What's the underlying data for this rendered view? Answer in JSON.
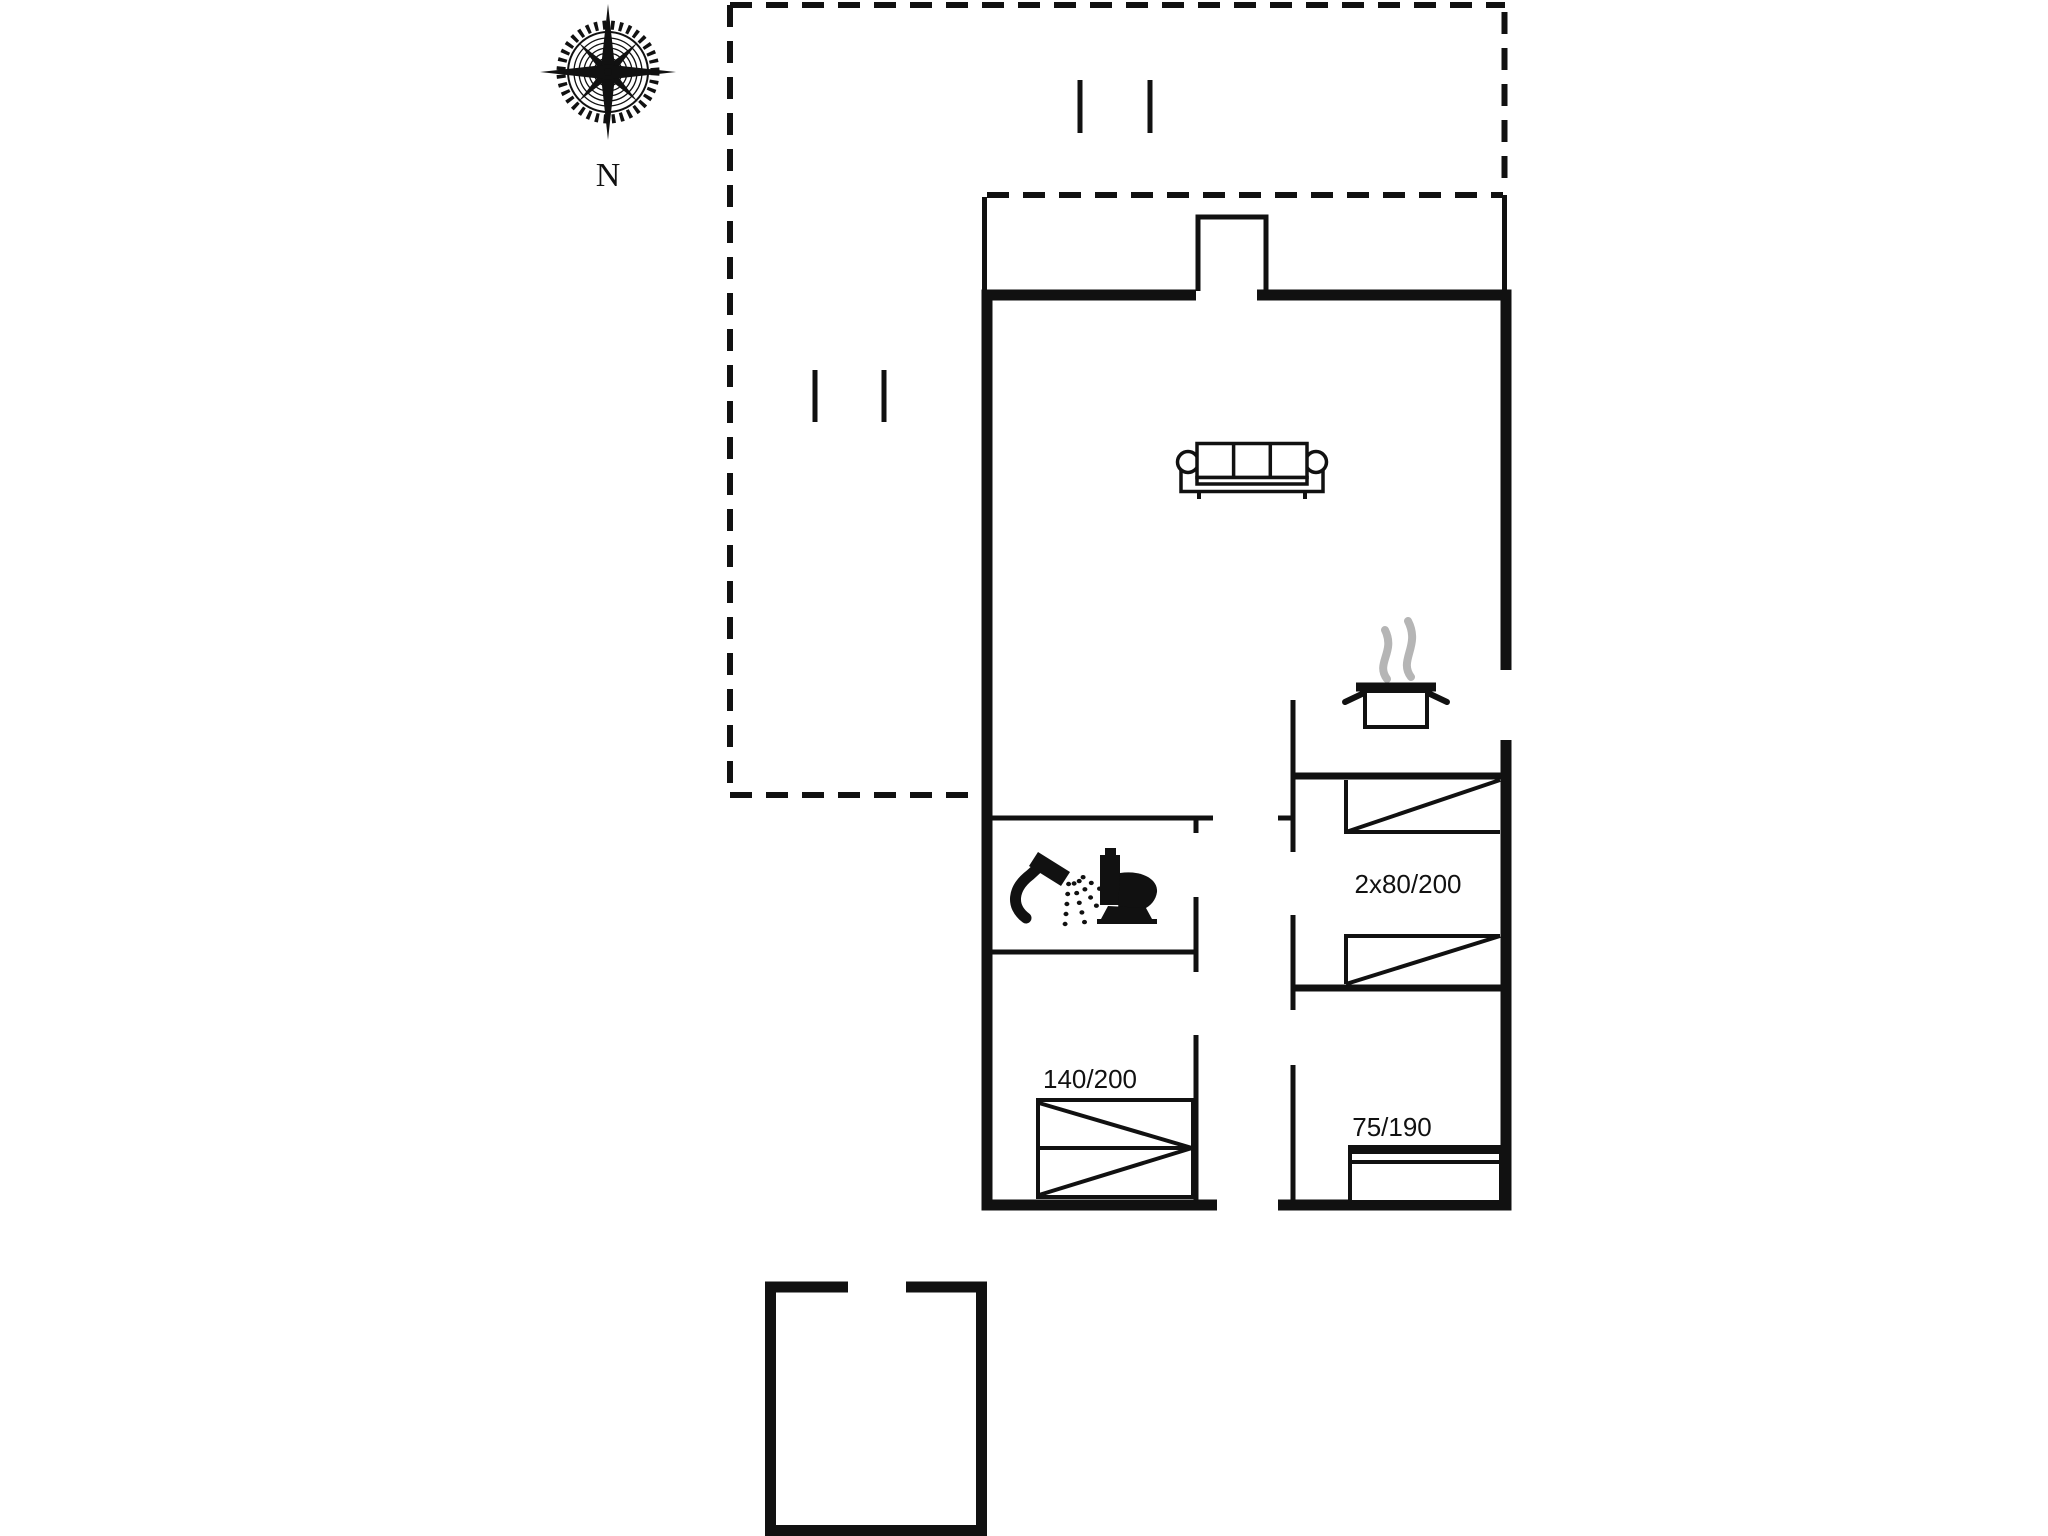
{
  "palette": {
    "ink": "#111111",
    "steam": "#b5b5b5",
    "bg": "#ffffff"
  },
  "compass": {
    "label": "N",
    "icon": "compass-rose"
  },
  "rooms": {
    "bedroom_twin": {
      "bed_size_label": "2x80/200"
    },
    "bedroom_double": {
      "bed_size_label": "140/200"
    },
    "bedroom_single": {
      "bed_size_label": "75/190"
    }
  },
  "icons": {
    "compass": "compass-rose-icon",
    "sofa": "sofa-icon",
    "stove_pot": "cooking-pot-icon",
    "steam": "steam-icon",
    "shower": "shower-icon",
    "toilet": "toilet-icon",
    "bed": "bed-icon"
  }
}
